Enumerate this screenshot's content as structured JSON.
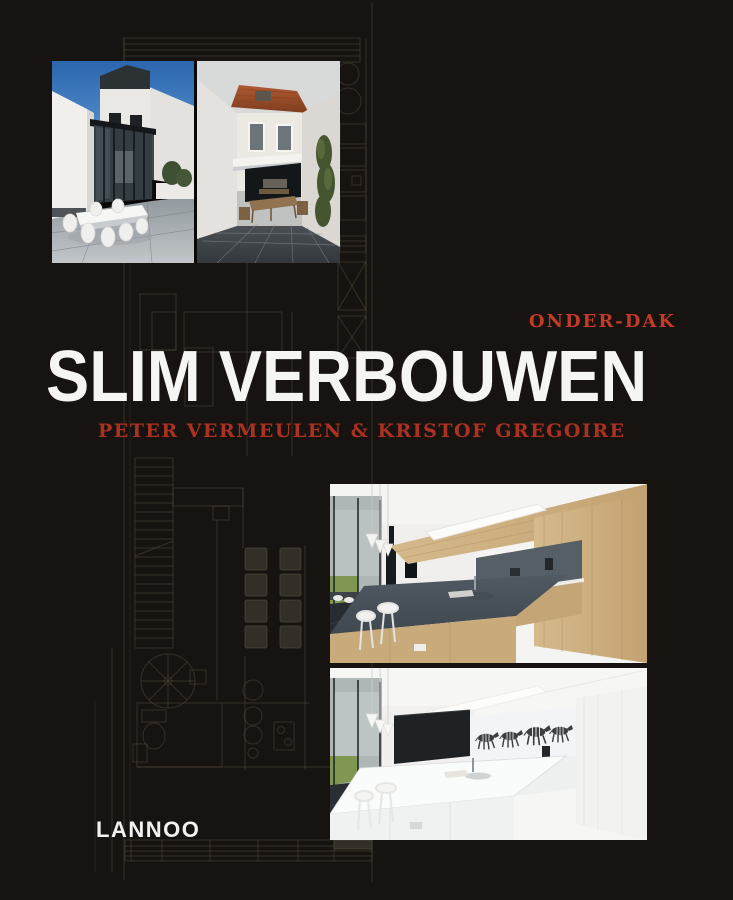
{
  "cover": {
    "series_label": "ONDER-DAK",
    "title": "SLIM VERBOUWEN",
    "authors": "PETER VERMEULEN & KRISTOF GREGOIRE",
    "publisher": "LANNOO"
  },
  "colors": {
    "background": "#171310",
    "series_red": "#c23a28",
    "authors_red": "#ab3123",
    "title_white": "#f5f5f3",
    "publisher_white": "#f2f1ef",
    "floorplan_line": "#5b5143"
  },
  "photos": {
    "exterior_left": "glass-extension-terrace-render",
    "exterior_right": "row-house-tiled-terrace-render",
    "kitchen_top": "wood-kitchen-interior-render",
    "kitchen_bottom": "white-kitchen-zebra-mural-render"
  }
}
